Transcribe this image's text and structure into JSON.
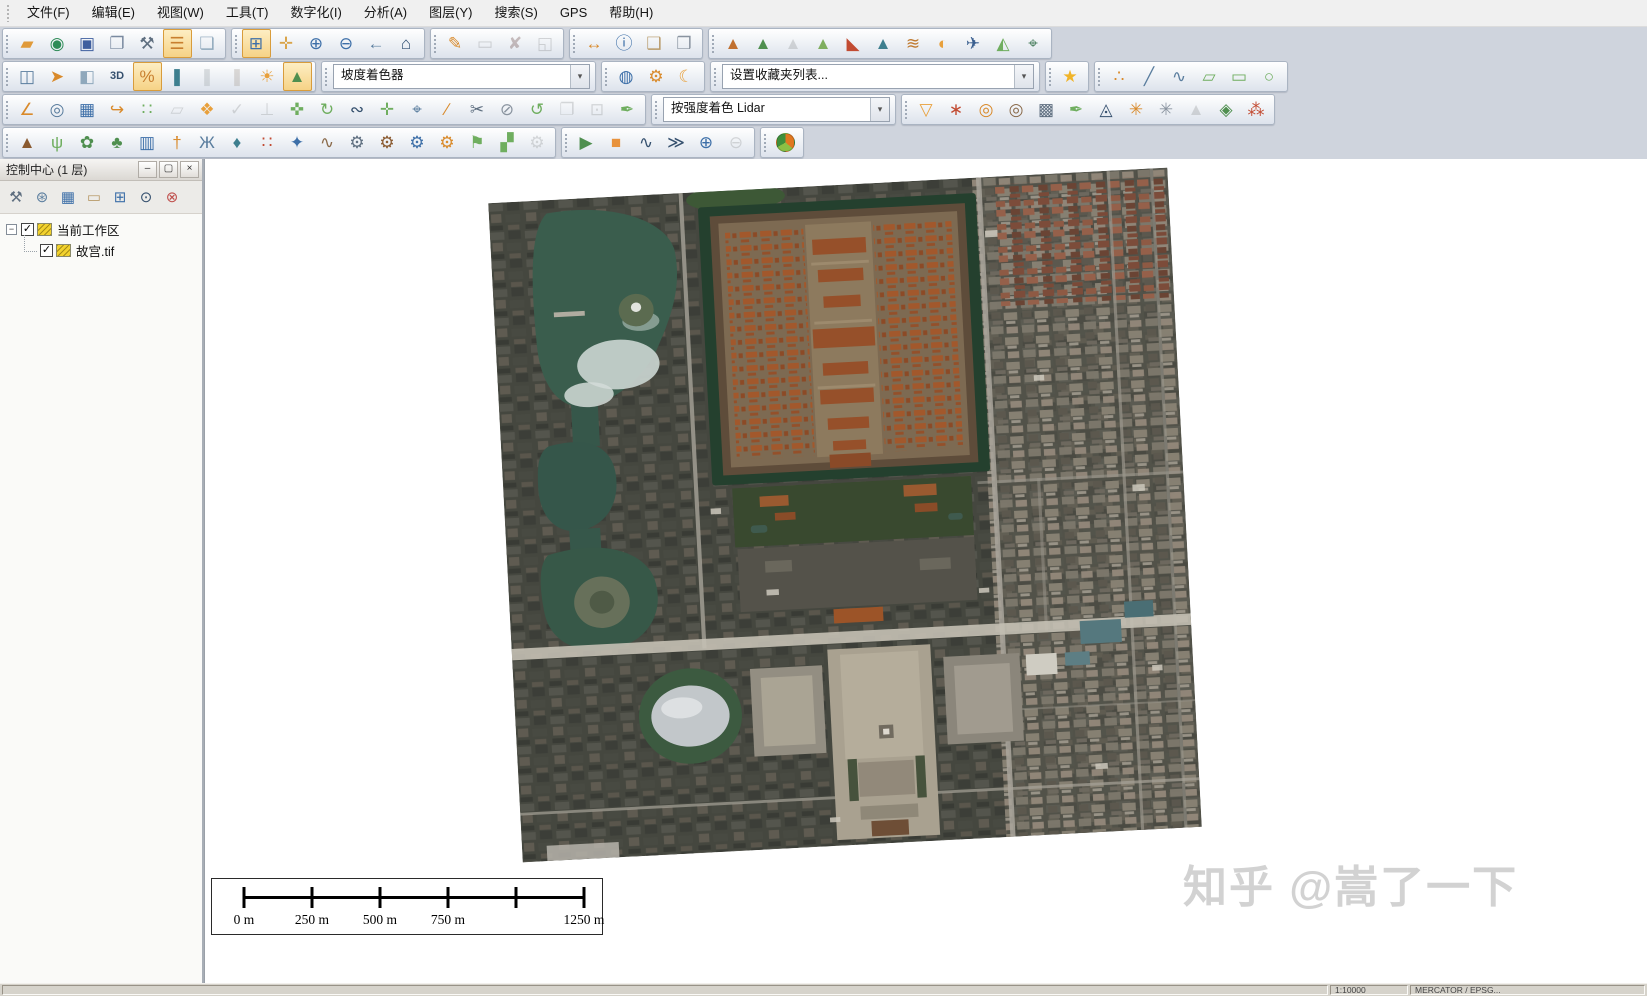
{
  "menu": {
    "items": [
      {
        "id": "file",
        "label": "文件(F)"
      },
      {
        "id": "edit",
        "label": "编辑(E)"
      },
      {
        "id": "view",
        "label": "视图(W)"
      },
      {
        "id": "tools",
        "label": "工具(T)"
      },
      {
        "id": "digitize",
        "label": "数字化(I)"
      },
      {
        "id": "analysis",
        "label": "分析(A)"
      },
      {
        "id": "layer",
        "label": "图层(Y)"
      },
      {
        "id": "search",
        "label": "搜索(S)"
      },
      {
        "id": "gps",
        "label": "GPS"
      },
      {
        "id": "help",
        "label": "帮助(H)"
      }
    ]
  },
  "icons": {
    "chevron_down": "▾",
    "checkmark": "✓",
    "collapse": "−",
    "minimize": "–",
    "maximize": "▢",
    "close": "×"
  },
  "toolbars": {
    "rows": [
      {
        "groups": [
          {
            "id": "file-tools",
            "buttons": [
              {
                "id": "open-file",
                "g": "▰",
                "c": "#e09a3a"
              },
              {
                "id": "download-online-data",
                "g": "◉",
                "c": "#2e8b57"
              },
              {
                "id": "save",
                "g": "▣",
                "c": "#3f5f9f"
              },
              {
                "id": "map-layout",
                "g": "❐",
                "c": "#7a8aa0"
              },
              {
                "id": "configure",
                "g": "⚒",
                "c": "#5f6f80"
              },
              {
                "id": "control-center",
                "g": "☰",
                "c": "#c87f2f",
                "a": true
              },
              {
                "id": "overlay-view",
                "g": "❏",
                "c": "#8fa8bc"
              }
            ]
          },
          {
            "id": "zoom-tools",
            "buttons": [
              {
                "id": "zoom-box",
                "g": "⊞",
                "c": "#3d6fa8",
                "a": true
              },
              {
                "id": "pan",
                "g": "✛",
                "c": "#d9a44a"
              },
              {
                "id": "zoom-in",
                "g": "⊕",
                "c": "#3d6fa8"
              },
              {
                "id": "zoom-out",
                "g": "⊖",
                "c": "#3d6fa8"
              },
              {
                "id": "previous-view",
                "g": "←",
                "c": "#5a7d9e"
              },
              {
                "id": "full-view",
                "g": "⌂",
                "c": "#2f4f72"
              }
            ]
          },
          {
            "id": "digitizer-quick",
            "buttons": [
              {
                "id": "digitizer-edit",
                "g": "✎",
                "c": "#d98a2b"
              },
              {
                "id": "select-features",
                "g": "▭",
                "c": "#8a94a0",
                "d": true
              },
              {
                "id": "delete-features",
                "g": "✘",
                "c": "#c0504d",
                "d": true
              },
              {
                "id": "digitizer-lock",
                "g": "◱",
                "c": "#8a94a0",
                "d": true
              }
            ]
          },
          {
            "id": "info-tools",
            "buttons": [
              {
                "id": "measure",
                "g": "↔",
                "c": "#d98a2b"
              },
              {
                "id": "feature-info",
                "g": "ⓘ",
                "c": "#3d6fa8"
              },
              {
                "id": "search-attributes",
                "g": "❑",
                "c": "#b89a6a"
              },
              {
                "id": "script-document",
                "g": "❒",
                "c": "#8a94a0"
              }
            ]
          },
          {
            "id": "terrain-analysis",
            "buttons": [
              {
                "id": "elevation-shader",
                "g": "▲",
                "c": "#c07030"
              },
              {
                "id": "contour-lines",
                "g": "▲",
                "c": "#4f8f4f"
              },
              {
                "id": "path-profile",
                "g": "▲",
                "c": "#9aa5ad",
                "d": true
              },
              {
                "id": "terrain-paint",
                "g": "▲",
                "c": "#7fae5f"
              },
              {
                "id": "viewshed",
                "g": "◣",
                "c": "#c24b32"
              },
              {
                "id": "watershed",
                "g": "▲",
                "c": "#3e7f8f"
              },
              {
                "id": "terrain-compare",
                "g": "≋",
                "c": "#c07a30"
              },
              {
                "id": "color-relief",
                "g": "◐",
                "c": "#e8a03c"
              },
              {
                "id": "fly-through",
                "g": "✈",
                "c": "#3a5f8f"
              },
              {
                "id": "terrain-sculpt",
                "g": "◭",
                "c": "#6fae5f"
              },
              {
                "id": "move-3d",
                "g": "⌖",
                "c": "#4a7f5f"
              }
            ]
          }
        ]
      },
      {
        "groups": [
          {
            "id": "view-tools",
            "buttons": [
              {
                "id": "split-screen",
                "g": "◫",
                "c": "#5a7d9e"
              },
              {
                "id": "compass",
                "g": "➤",
                "c": "#d98a2b"
              },
              {
                "id": "dock-view",
                "g": "◧",
                "c": "#8fa8bc"
              },
              {
                "id": "view-3d",
                "g": "3D",
                "c": "#35506e"
              },
              {
                "id": "transparency-percent",
                "g": "%",
                "c": "#c87f2f",
                "a": true
              },
              {
                "id": "water-level",
                "g": "❚",
                "c": "#3e7f8f"
              },
              {
                "id": "water-level-plus",
                "g": "❚",
                "c": "#9ab4c4",
                "d": true
              },
              {
                "id": "heat-level",
                "g": "❚",
                "c": "#c4a68a",
                "d": true
              },
              {
                "id": "sun-hillshade",
                "g": "☀",
                "c": "#e8a03c"
              },
              {
                "id": "slope-shader-toggle",
                "g": "▲",
                "c": "#4f8f4f",
                "a": true
              }
            ]
          },
          {
            "id": "shader-select",
            "type": "dropdown",
            "value": "坡度着色器",
            "w": 255
          },
          {
            "id": "globe-tools",
            "buttons": [
              {
                "id": "projection-globe",
                "g": "◍",
                "c": "#3d6fa8"
              },
              {
                "id": "display-options",
                "g": "⚙",
                "c": "#d98a2b"
              },
              {
                "id": "night-mode",
                "g": "☾",
                "c": "#e8a03c"
              }
            ]
          },
          {
            "id": "favorites-select",
            "type": "dropdown",
            "value": "设置收藏夹列表...",
            "w": 310
          },
          {
            "id": "favorites",
            "buttons": [
              {
                "id": "favorite-star",
                "g": "★",
                "c": "#f0b429"
              }
            ]
          },
          {
            "id": "draw-tools",
            "buttons": [
              {
                "id": "draw-point",
                "g": "∴",
                "c": "#d98a2b"
              },
              {
                "id": "draw-line",
                "g": "╱",
                "c": "#5a7d9e"
              },
              {
                "id": "draw-curve",
                "g": "∿",
                "c": "#5a7d9e"
              },
              {
                "id": "draw-polygon",
                "g": "▱",
                "c": "#6fae5f"
              },
              {
                "id": "draw-rectangle",
                "g": "▭",
                "c": "#6fae5f"
              },
              {
                "id": "draw-circle",
                "g": "○",
                "c": "#6fae5f"
              }
            ]
          }
        ]
      },
      {
        "groups": [
          {
            "id": "edit-tools",
            "buttons": [
              {
                "id": "angle-measure",
                "g": "∠",
                "c": "#d98a2b"
              },
              {
                "id": "range-rings",
                "g": "◎",
                "c": "#5a7d9e"
              },
              {
                "id": "draw-grid",
                "g": "▦",
                "c": "#3d6fa8"
              },
              {
                "id": "trace-feature",
                "g": "↪",
                "c": "#d98a2b"
              },
              {
                "id": "draw-cells",
                "g": "∷",
                "c": "#6fae5f"
              },
              {
                "id": "copy-polygon",
                "g": "▱",
                "c": "#9aa5ad",
                "d": true
              },
              {
                "id": "buffer-features",
                "g": "❖",
                "c": "#e8a03c"
              },
              {
                "id": "verify-features",
                "g": "✓",
                "c": "#9aa5ad",
                "d": true
              },
              {
                "id": "lift-feature",
                "g": "⊥",
                "c": "#9aa5ad",
                "d": true
              },
              {
                "id": "move-feature",
                "g": "✜",
                "c": "#6fae5f"
              },
              {
                "id": "rotate-feature",
                "g": "↻",
                "c": "#6fae5f"
              },
              {
                "id": "edit-vertices",
                "g": "∾",
                "c": "#35506e"
              },
              {
                "id": "move-vertex",
                "g": "✛",
                "c": "#6fae5f"
              },
              {
                "id": "snap-vertex",
                "g": "⌖",
                "c": "#5a7d9e"
              },
              {
                "id": "attach-line",
                "g": "∕",
                "c": "#d98a2b"
              },
              {
                "id": "split-feature",
                "g": "✂",
                "c": "#5f6f80"
              },
              {
                "id": "erase-vertices",
                "g": "⊘",
                "c": "#8a94a0"
              },
              {
                "id": "rotate-shapes",
                "g": "↺",
                "c": "#6fae5f"
              },
              {
                "id": "copy-shapes",
                "g": "❐",
                "c": "#9aa5ad",
                "d": true
              },
              {
                "id": "crop-grid",
                "g": "⊡",
                "c": "#9aa5ad",
                "d": true
              },
              {
                "id": "smooth-pen",
                "g": "✒",
                "c": "#6fae5f"
              }
            ]
          },
          {
            "id": "lidar-select",
            "type": "dropdown",
            "value": "按强度着色 Lidar",
            "w": 225
          },
          {
            "id": "lidar-tools",
            "buttons": [
              {
                "id": "lidar-filter",
                "g": "▽",
                "c": "#e8a03c"
              },
              {
                "id": "lidar-classify",
                "g": "∗",
                "c": "#c24b32"
              },
              {
                "id": "lidar-query",
                "g": "◎",
                "c": "#d98a2b"
              },
              {
                "id": "lidar-query-plus",
                "g": "◎",
                "c": "#8a6a4a"
              },
              {
                "id": "lidar-cross-section",
                "g": "▩",
                "c": "#5f6f80"
              },
              {
                "id": "lidar-extract",
                "g": "✒",
                "c": "#6fae5f"
              },
              {
                "id": "lidar-triangulate",
                "g": "◬",
                "c": "#35506e"
              },
              {
                "id": "lidar-cluster",
                "g": "✳",
                "c": "#d98a2b"
              },
              {
                "id": "lidar-cluster-auto",
                "g": "✳",
                "c": "#8a94a0"
              },
              {
                "id": "lidar-contour",
                "g": "▲",
                "c": "#9aa5ad",
                "d": true
              },
              {
                "id": "lidar-surface",
                "g": "◈",
                "c": "#4f8f4f"
              },
              {
                "id": "lidar-fit",
                "g": "⁂",
                "c": "#c24b32"
              }
            ]
          }
        ]
      },
      {
        "groups": [
          {
            "id": "classify-tools",
            "buttons": [
              {
                "id": "classify-ground",
                "g": "▲",
                "c": "#8a5a30"
              },
              {
                "id": "classify-grass",
                "g": "ψ",
                "c": "#6fae5f"
              },
              {
                "id": "classify-shrub",
                "g": "✿",
                "c": "#4f8f4f"
              },
              {
                "id": "classify-tree",
                "g": "♣",
                "c": "#4f8f4f"
              },
              {
                "id": "classify-building",
                "g": "▥",
                "c": "#3d6fa8"
              },
              {
                "id": "classify-pole",
                "g": "†",
                "c": "#d98a2b"
              },
              {
                "id": "classify-powerline",
                "g": "Ж",
                "c": "#5a7d9e"
              },
              {
                "id": "classify-water",
                "g": "♦",
                "c": "#3e7f8f"
              },
              {
                "id": "classify-noise",
                "g": "∷",
                "c": "#c24b32"
              },
              {
                "id": "classify-keypoints",
                "g": "✦",
                "c": "#3d6fa8"
              },
              {
                "id": "path-profile-points",
                "g": "∿",
                "c": "#8a6a4a"
              },
              {
                "id": "auto-classify-points",
                "g": "⚙",
                "c": "#5f6f80"
              },
              {
                "id": "auto-classify-ground",
                "g": "⚙",
                "c": "#8a5a30"
              },
              {
                "id": "auto-classify-buildings",
                "g": "⚙",
                "c": "#3d6fa8"
              },
              {
                "id": "auto-classify-poles",
                "g": "⚙",
                "c": "#d98a2b"
              },
              {
                "id": "flag-region",
                "g": "⚑",
                "c": "#6fae5f"
              },
              {
                "id": "merge-clouds",
                "g": "▞",
                "c": "#6fae5f"
              },
              {
                "id": "custom-classify",
                "g": "⚙",
                "c": "#9aa5ad",
                "d": true
              }
            ]
          },
          {
            "id": "playback-tools",
            "buttons": [
              {
                "id": "play",
                "g": "▶",
                "c": "#4f8f4f"
              },
              {
                "id": "stop",
                "g": "■",
                "c": "#e8923c"
              },
              {
                "id": "slower-turtle",
                "g": "∿",
                "c": "#35506e"
              },
              {
                "id": "faster-rabbit",
                "g": "≫",
                "c": "#35506e"
              },
              {
                "id": "add-frame",
                "g": "⊕",
                "c": "#3d6fa8"
              },
              {
                "id": "remove-frame",
                "g": "⊖",
                "c": "#9aa5ad",
                "d": true
              }
            ]
          },
          {
            "id": "palette",
            "buttons": [
              {
                "id": "color-palette",
                "g": "PIE",
                "c": "#e07820"
              }
            ]
          }
        ]
      }
    ]
  },
  "panel": {
    "title": "控制中心 (1 层)",
    "tools": [
      {
        "id": "layer-options",
        "g": "⚒",
        "c": "#5f6f80"
      },
      {
        "id": "layer-metadata",
        "g": "⊛",
        "c": "#5a7d9e"
      },
      {
        "id": "layer-attributes",
        "g": "▦",
        "c": "#3d6fa8"
      },
      {
        "id": "layer-select",
        "g": "▭",
        "c": "#b89a6a"
      },
      {
        "id": "layer-zoom",
        "g": "⊞",
        "c": "#3d6fa8"
      },
      {
        "id": "layer-visibility",
        "g": "⊙",
        "c": "#35506e"
      },
      {
        "id": "layer-close",
        "g": "⊗",
        "c": "#c0504d"
      }
    ],
    "tree": [
      {
        "depth": 0,
        "expand": true,
        "checked": true,
        "label": "当前工作区"
      },
      {
        "depth": 1,
        "expand": false,
        "checked": true,
        "label": "故宫.tif"
      }
    ]
  },
  "scalebar": {
    "ticks": [
      0,
      0.2,
      0.4,
      0.6,
      0.8,
      1
    ],
    "labels": [
      {
        "text": "0 m",
        "pos": 0
      },
      {
        "text": "250 m",
        "pos": 0.2
      },
      {
        "text": "500 m",
        "pos": 0.4
      },
      {
        "text": "750 m",
        "pos": 0.6
      },
      {
        "text": "1250 m",
        "pos": 1
      }
    ]
  },
  "watermark": {
    "text": "知乎 @嵩了一下"
  },
  "statusbar": {
    "cells": [
      {
        "text": "",
        "flex": true
      },
      {
        "text": "1:10000",
        "w": 78
      },
      {
        "text": "MERCATOR / EPSG...",
        "w": 235
      }
    ]
  }
}
